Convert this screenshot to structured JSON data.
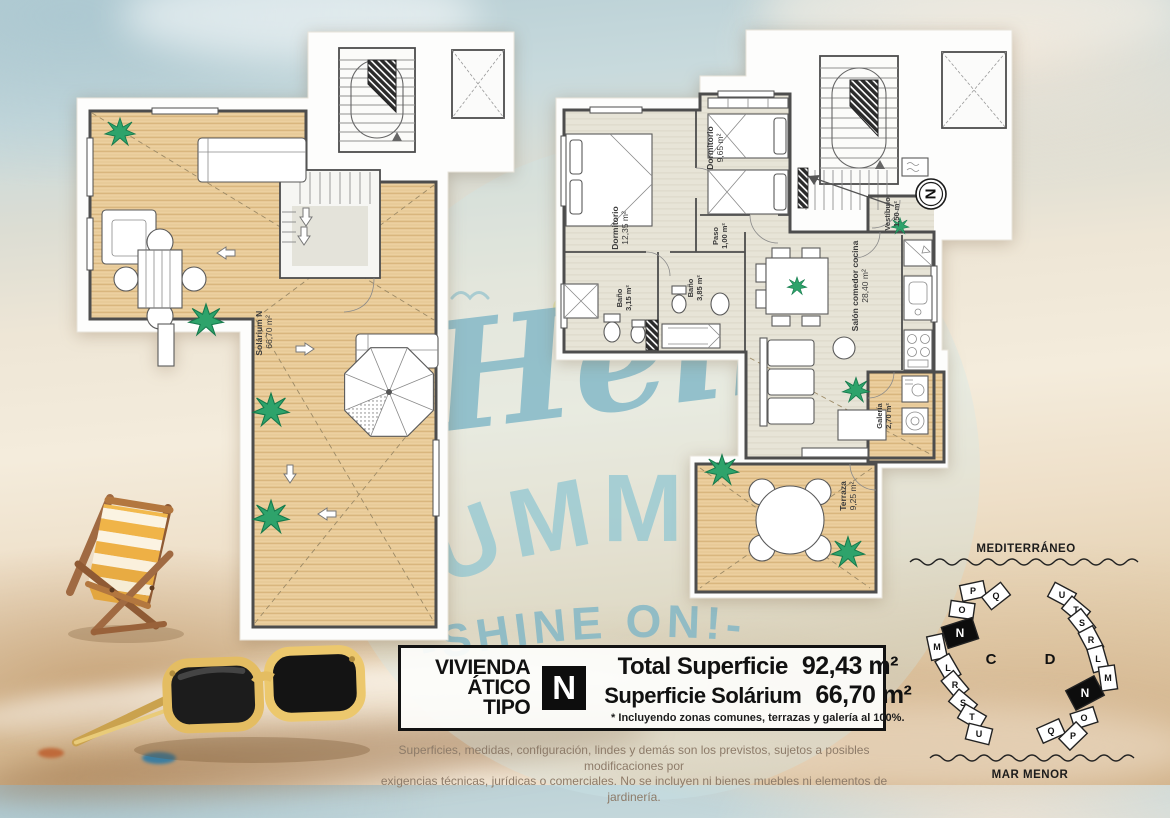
{
  "watermark": {
    "hello": "Hello",
    "summer": "SUMMER",
    "shine": "-SHINE ON!-"
  },
  "plan_left": {
    "room_label": "Solárium N",
    "room_area": "66,70 m²"
  },
  "plan_right": {
    "compass_letter": "N",
    "rooms": [
      {
        "name": "Dormitorio",
        "area": "12,35 m²"
      },
      {
        "name": "Dormitorio",
        "area": "9,65 m²"
      },
      {
        "name": "Paso",
        "area": "1,00 m²"
      },
      {
        "name": "Baño",
        "area": "3,15 m²"
      },
      {
        "name": "Baño",
        "area": "3,85 m²"
      },
      {
        "name": "Salón comedor cocina",
        "area": "28,40 m²"
      },
      {
        "name": "Vestíbulo",
        "area": "1,50 m²"
      },
      {
        "name": "Galería",
        "area": "2,70 m²"
      },
      {
        "name": "Terraza",
        "area": "9,25 m²"
      }
    ]
  },
  "info_box": {
    "dwelling_line1": "VIVIENDA",
    "dwelling_line2": "ÁTICO TIPO",
    "type_letter": "N",
    "total_label": "Total Superficie",
    "total_value": "92,43 m²",
    "solarium_label": "Superficie Solárium",
    "solarium_value": "66,70 m²",
    "footnote": "* Incluyendo zonas comunes, terrazas y galería al 100%."
  },
  "disclaimer": {
    "line1": "Superficies, medidas, configuración, lindes y demás son los previstos, sujetos a posibles modificaciones por",
    "line2": "exigencias técnicas, jurídicas o comerciales. No se incluyen ni bienes muebles ni elementos de jardinería."
  },
  "site_plan": {
    "sea_top": "MEDITERRÁNEO",
    "sea_bottom": "MAR MENOR",
    "block_c": {
      "label": "C",
      "units": [
        "P",
        "Q",
        "O",
        "N",
        "M",
        "L",
        "R",
        "S",
        "T",
        "U"
      ]
    },
    "block_d": {
      "label": "D",
      "units": [
        "U",
        "T",
        "S",
        "R",
        "L",
        "M",
        "N",
        "O",
        "Q",
        "P"
      ]
    },
    "highlighted_unit": "N"
  },
  "colors": {
    "watermark_blue": "#7fb6c6",
    "deck_wood": "#ecd0a0",
    "interior_floor": "#e7e4d8",
    "accent_black": "#111111",
    "sunglasses_frame": "#e4bd62"
  }
}
